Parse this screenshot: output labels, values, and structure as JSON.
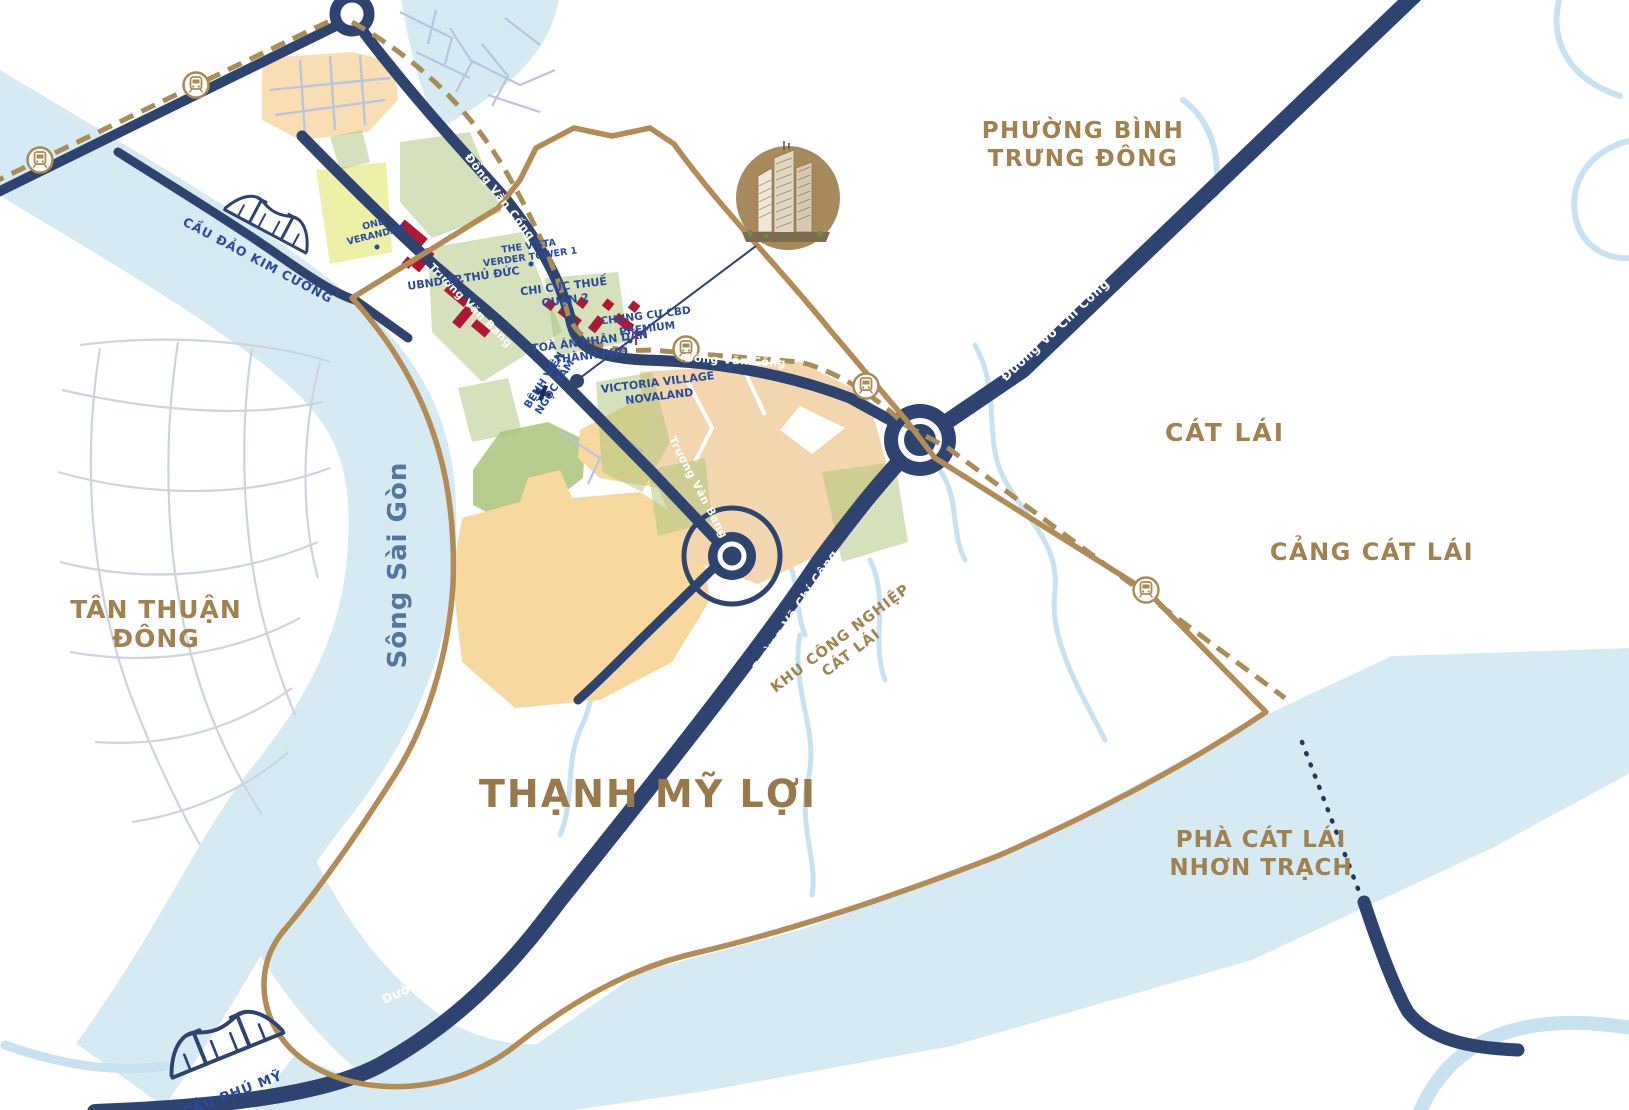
{
  "map": {
    "region": "Thạnh Mỹ Lợi",
    "colors": {
      "water": "#d5eaf2",
      "creek": "#c9e2f1",
      "road_navy": "#2e4370",
      "boundary_gold": "#b28b55",
      "metro_dash_gold": "#a98d58",
      "zone_peach": "#f3d6ae",
      "zone_sand": "#f7d89e",
      "zone_sage": "#b7cd90",
      "zone_lime": "#edf0a6",
      "speckle_green": "#a9c478",
      "building_red": "#b01730",
      "text_gold": "#a08150",
      "text_blue": "#2b4a9b"
    },
    "icons": {
      "metro-station-icon": "train front in gold circle",
      "bridge-icon": "suspension bridge silhouette",
      "hospital-cross-icon": "+",
      "project-marker-icon": "high-rise towers in gold circle",
      "poi-dot-icon": "small navy dot",
      "flag-icon": "small red flag"
    },
    "labels": [
      {
        "id": "phuong-binh-trung-dong",
        "lines": [
          "PHƯỜNG BÌNH",
          "TRƯNG ĐÔNG"
        ],
        "x": 1083,
        "y": 138,
        "rot": 0,
        "cls": "lbl-gold",
        "size": 23,
        "lh": 28,
        "ls": 1.5
      },
      {
        "id": "cat-lai",
        "lines": [
          "CÁT LÁI"
        ],
        "x": 1225,
        "y": 441,
        "rot": 0,
        "cls": "lbl-gold",
        "size": 25,
        "lh": 0,
        "ls": 2
      },
      {
        "id": "cang-cat-lai",
        "lines": [
          "CẢNG CÁT LÁI"
        ],
        "x": 1372,
        "y": 560,
        "rot": 0,
        "cls": "lbl-gold",
        "size": 24,
        "lh": 0,
        "ls": 1.5
      },
      {
        "id": "tan-thuan-dong",
        "lines": [
          "TÂN THUẬN",
          "ĐÔNG"
        ],
        "x": 156,
        "y": 618,
        "rot": 0,
        "cls": "lbl-gold",
        "size": 25,
        "lh": 29,
        "ls": 1
      },
      {
        "id": "thanh-my-loi",
        "lines": [
          "THẠNH MỸ LỢI"
        ],
        "x": 648,
        "y": 807,
        "rot": 0,
        "cls": "lbl-gold-xl",
        "size": 38,
        "lh": 0,
        "ls": 2
      },
      {
        "id": "pha-cat-lai-nhon-trach",
        "lines": [
          "PHÀ CÁT LÁI",
          "NHƠN TRẠCH"
        ],
        "x": 1261,
        "y": 847,
        "rot": 0,
        "cls": "lbl-gold",
        "size": 23,
        "lh": 28,
        "ls": 1
      },
      {
        "id": "khu-cong-nghiep-cat-lai",
        "lines": [
          "KHU CÔNG NGHIỆP",
          "CÁT LÁI"
        ],
        "x": 843,
        "y": 642,
        "rot": -37,
        "cls": "lbl-gold-sm",
        "size": 14.5,
        "lh": 18,
        "ls": 1
      },
      {
        "id": "song-sai-gon",
        "lines": [
          "Sông Sài Gòn"
        ],
        "x": 406,
        "y": 565,
        "rot": -90,
        "cls": "lbl-river",
        "size": 26,
        "lh": 0,
        "ls": 1
      },
      {
        "id": "road-dong-van-cong-1",
        "lines": [
          "Đồng Văn Cống"
        ],
        "x": 497,
        "y": 199,
        "rot": 52,
        "cls": "lbl-white",
        "size": 11.5,
        "lh": 0,
        "ls": 0.5
      },
      {
        "id": "road-truong-van-bang-1",
        "lines": [
          "Trương Văn Bang"
        ],
        "x": 468,
        "y": 308,
        "rot": 45,
        "cls": "lbl-white",
        "size": 11,
        "lh": 0,
        "ls": 0.5
      },
      {
        "id": "road-truong-van-bang-2",
        "lines": [
          "Trương Văn Bang"
        ],
        "x": 695,
        "y": 489,
        "rot": 62,
        "cls": "lbl-white",
        "size": 11,
        "lh": 0,
        "ls": 0.5
      },
      {
        "id": "road-dong-van-cong-2",
        "lines": [
          "Đồng Văn Cống"
        ],
        "x": 735,
        "y": 364,
        "rot": 3,
        "cls": "lbl-white",
        "size": 11,
        "lh": 0,
        "ls": 0.5
      },
      {
        "id": "road-vo-chi-cong-1",
        "lines": [
          "Đường Võ Chí Công"
        ],
        "x": 1058,
        "y": 333,
        "rot": -43,
        "cls": "lbl-white",
        "size": 12.5,
        "lh": 0,
        "ls": 0.5
      },
      {
        "id": "road-vo-chi-cong-2",
        "lines": [
          "Đường Võ Chí Công"
        ],
        "x": 799,
        "y": 613,
        "rot": -56,
        "cls": "lbl-white",
        "size": 12.5,
        "lh": 0,
        "ls": 0.5
      },
      {
        "id": "road-vo-chi-cong-3",
        "lines": [
          "Đường Võ Chí Công"
        ],
        "x": 449,
        "y": 974,
        "rot": -25,
        "cls": "lbl-white",
        "size": 12.5,
        "lh": 0,
        "ls": 0.5
      },
      {
        "id": "cau-dao-kim-cuong",
        "lines": [
          "CẦU ĐẢO KIM CƯƠNG"
        ],
        "x": 256,
        "y": 264,
        "rot": 28,
        "cls": "lbl-blue",
        "size": 12.5,
        "lh": 0,
        "ls": 1
      },
      {
        "id": "cau-phu-my",
        "lines": [
          "CẦU PHÚ MỸ"
        ],
        "x": 234,
        "y": 1098,
        "rot": -21,
        "cls": "lbl-blue",
        "size": 13.5,
        "lh": 0,
        "ls": 1
      },
      {
        "id": "one-verandah",
        "lines": [
          "ONE",
          "VERANDAH"
        ],
        "x": 374,
        "y": 227,
        "rot": -14,
        "cls": "lbl-blue",
        "size": 9.5,
        "lh": 11,
        "ls": 0
      },
      {
        "id": "the-vista-verder-tower",
        "lines": [
          "THE VISTA",
          "VERDER TOWER 1"
        ],
        "x": 529,
        "y": 249,
        "rot": -8,
        "cls": "lbl-blue",
        "size": 9.5,
        "lh": 11,
        "ls": 0
      },
      {
        "id": "ubnd-tp-thu-duc",
        "lines": [
          "UBND TP.THỦ ĐỨC"
        ],
        "x": 464,
        "y": 282,
        "rot": -8,
        "cls": "lbl-blue",
        "size": 11,
        "lh": 0,
        "ls": 0
      },
      {
        "id": "chi-cuc-thue-quan-2",
        "lines": [
          "CHI CỤC THUẾ",
          "QUẬN 2"
        ],
        "x": 564,
        "y": 290,
        "rot": -7,
        "cls": "lbl-blue",
        "size": 11,
        "lh": 14,
        "ls": 0
      },
      {
        "id": "chung-cu-cbd-premium",
        "lines": [
          "CHUNG CƯ CBD",
          "PREMIUM"
        ],
        "x": 646,
        "y": 319,
        "rot": -7,
        "cls": "lbl-blue",
        "size": 10.5,
        "lh": 13,
        "ls": 0
      },
      {
        "id": "toa-an-nhan-dan",
        "lines": [
          "TOÀ ÁN NHÂN DÂN",
          "THÀNH PHỐ"
        ],
        "x": 590,
        "y": 345,
        "rot": -7,
        "cls": "lbl-blue",
        "size": 11,
        "lh": 14,
        "ls": 0
      },
      {
        "id": "victoria-village-novaland",
        "lines": [
          "VICTORIA VILLAGE",
          "NOVALAND"
        ],
        "x": 658,
        "y": 386,
        "rot": -7,
        "cls": "lbl-blue",
        "size": 11,
        "lh": 14,
        "ls": 0
      },
      {
        "id": "benh-vien-ngoc-tam",
        "lines": [
          "BỆNH VIỆN",
          "NGỌC TÂM"
        ],
        "x": 547,
        "y": 382,
        "rot": -57,
        "cls": "lbl-blue",
        "size": 10.5,
        "lh": 12.5,
        "ls": 0
      }
    ]
  }
}
